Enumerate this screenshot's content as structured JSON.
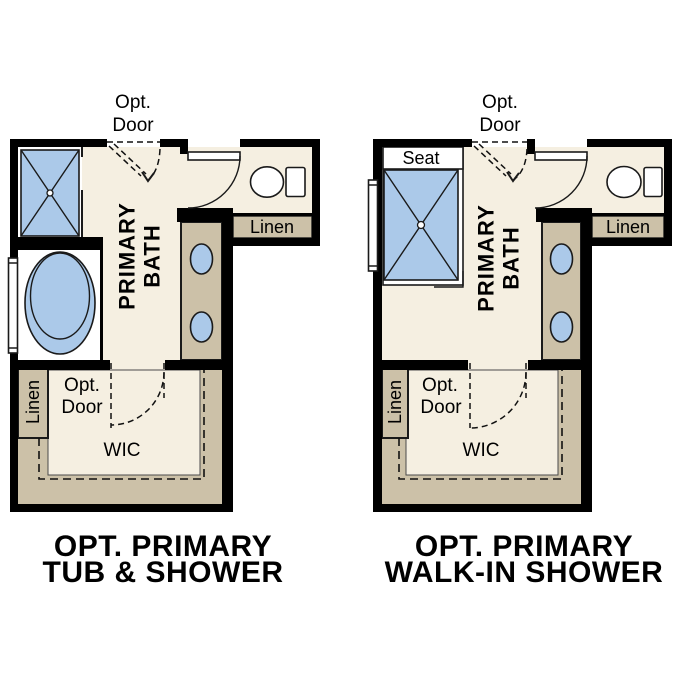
{
  "figure": {
    "type": "architectural-floor-plan-options",
    "background": "#ffffff"
  },
  "colors": {
    "floor_cream": "#f5efe1",
    "cabinet_tan": "#ccc1a8",
    "fixture_blue": "#abc9e9",
    "wall_black": "#000000",
    "room_white": "#ffffff",
    "text": "#000000"
  },
  "plans": [
    {
      "id": "tub-and-shower",
      "caption_line1": "OPT. PRIMARY",
      "caption_line2": "TUB & SHOWER",
      "opt_door_top_1": "Opt.",
      "opt_door_top_2": "Door",
      "room_line1": "PRIMARY",
      "room_line2": "BATH",
      "linen_upper": "Linen",
      "opt_door_lower_1": "Opt.",
      "opt_door_lower_2": "Door",
      "linen_lower": "Linen",
      "closet": "WIC",
      "fixtures": [
        "shower",
        "bathtub",
        "toilet",
        "double-sink-vanity",
        "window"
      ]
    },
    {
      "id": "walk-in-shower",
      "caption_line1": "OPT. PRIMARY",
      "caption_line2": "WALK-IN SHOWER",
      "seat": "Seat",
      "opt_door_top_1": "Opt.",
      "opt_door_top_2": "Door",
      "room_line1": "PRIMARY",
      "room_line2": "BATH",
      "linen_upper": "Linen",
      "opt_door_lower_1": "Opt.",
      "opt_door_lower_2": "Door",
      "linen_lower": "Linen",
      "closet": "WIC",
      "fixtures": [
        "walk-in-shower-with-seat",
        "toilet",
        "double-sink-vanity",
        "window"
      ]
    }
  ]
}
